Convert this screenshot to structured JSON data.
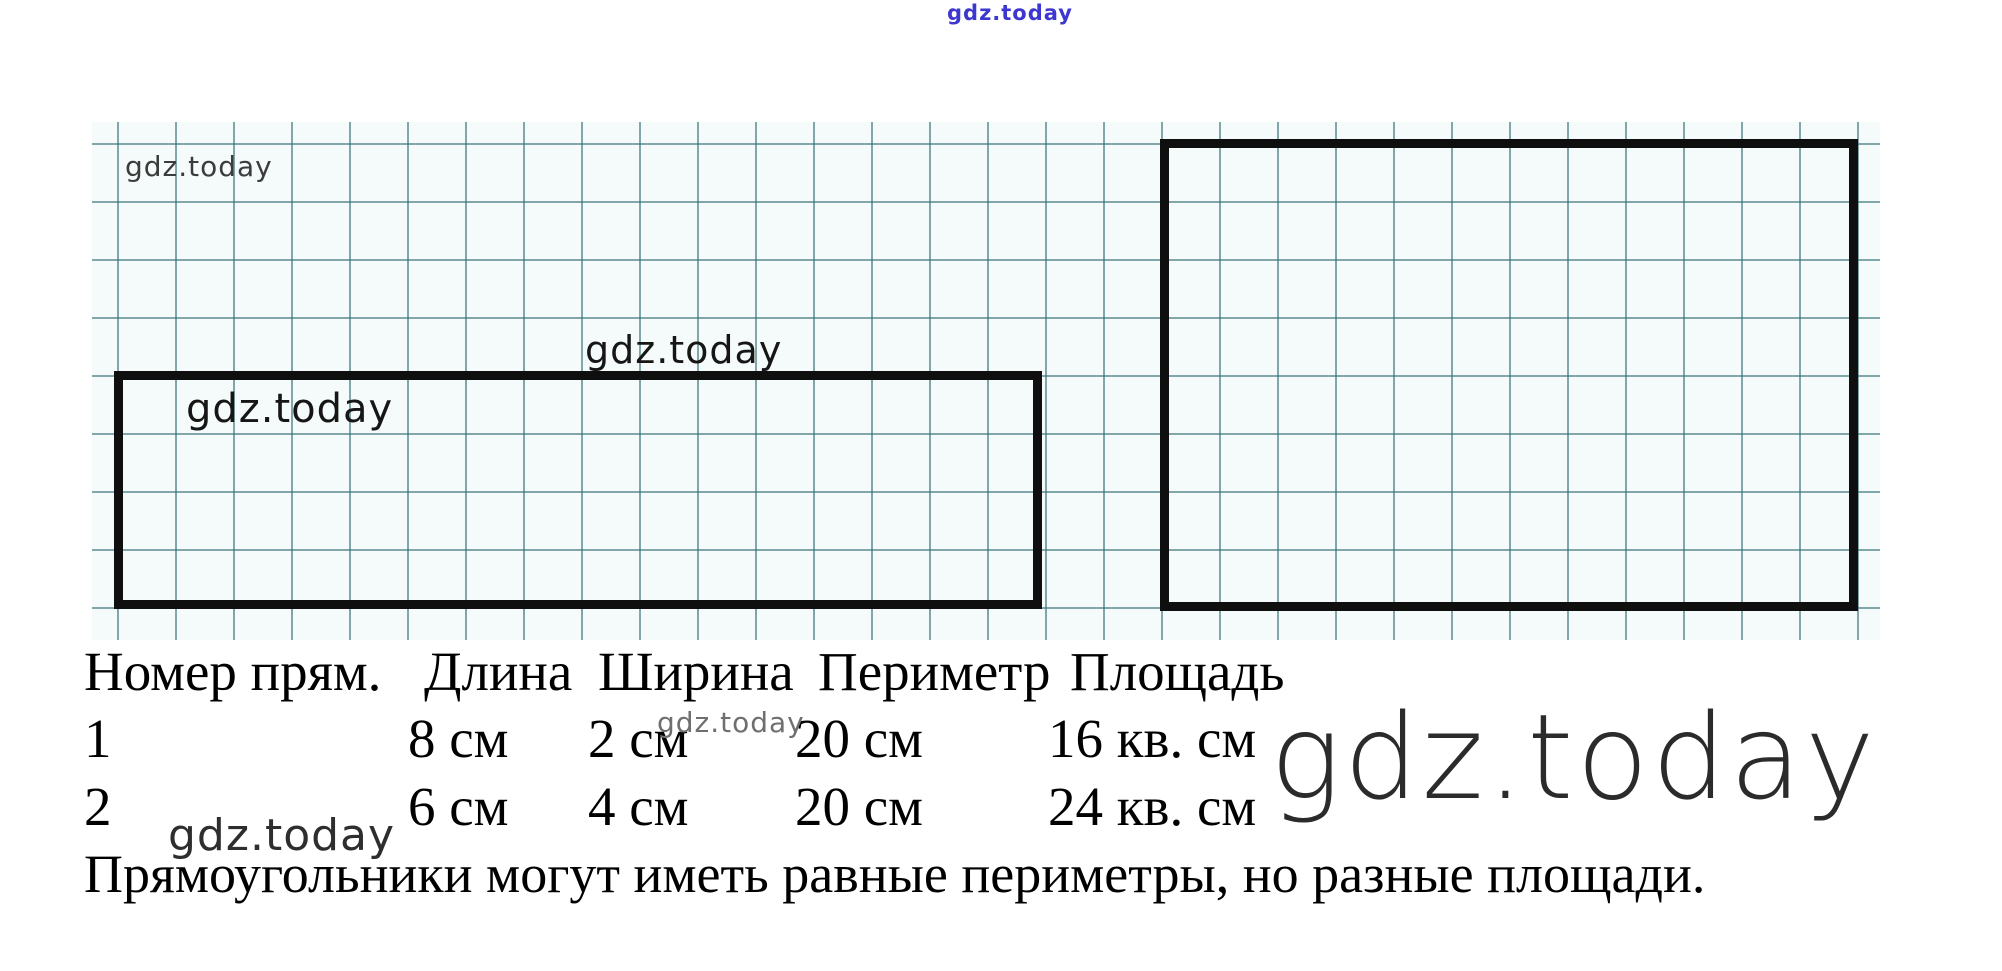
{
  "watermarks": {
    "top": "gdz.today",
    "grid_top_left": "gdz.today",
    "above_rect1": "gdz.today",
    "inside_rect1": "gdz.today",
    "row1_small": "gdz.today",
    "big_right": "gdz.today",
    "bottom_left": "gdz.today"
  },
  "figures": {
    "grid_cell_px": 58,
    "rect1": {
      "width_cells": 16,
      "height_cells": 4
    },
    "rect2": {
      "width_cells": 12,
      "height_cells": 8
    }
  },
  "table": {
    "headers": [
      "Номер прям.",
      "Длина",
      "Ширина",
      "Периметр",
      "Площадь"
    ],
    "rows": [
      {
        "num": "1",
        "length": "8 см",
        "width": "2 см",
        "perimeter": "20 см",
        "area": "16 кв. см"
      },
      {
        "num": "2",
        "length": "6 см",
        "width": "4 см",
        "perimeter": "20 см",
        "area": "24 кв. см"
      }
    ]
  },
  "conclusion": "Прямоугольники могут иметь равные периметры, но разные площади.",
  "colors": {
    "paper": "#f5fbfa",
    "grid_line": "#347076",
    "rect_border": "#0f0f0f",
    "watermark_blue": "#3d36cf",
    "text": "#000000"
  }
}
